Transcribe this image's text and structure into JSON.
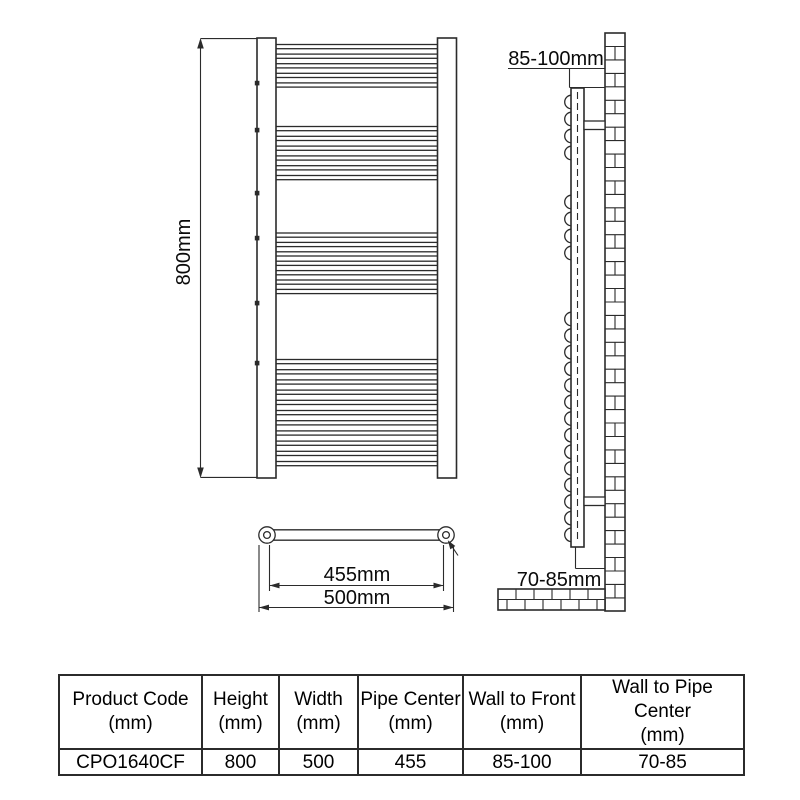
{
  "diagram": {
    "front_view": {
      "height_label": "800mm",
      "bar_groups": [
        {
          "y": 44.5,
          "pitch": 9.6,
          "count": 5
        },
        {
          "y": 126.5,
          "pitch": 9.8,
          "count": 6
        },
        {
          "y": 233.0,
          "pitch": 9.4,
          "count": 7
        },
        {
          "y": 359.5,
          "pitch": 10.2,
          "count": 11
        }
      ],
      "bracket_marks_y": [
        83,
        130,
        193,
        238,
        303,
        363
      ]
    },
    "side_view": {
      "wall_to_front_label": "85-100mm",
      "wall_to_pipe_label": "70-85mm",
      "bump_groups": [
        {
          "y": 102,
          "pitch": 17.0,
          "count": 4
        },
        {
          "y": 202,
          "pitch": 17.0,
          "count": 4
        },
        {
          "y": 319,
          "pitch": 16.6,
          "count": 14
        }
      ]
    },
    "bottom_view": {
      "pipe_center_label": "455mm",
      "overall_width_label": "500mm"
    }
  },
  "spec_table": {
    "columns": [
      {
        "label": "Product Code",
        "unit": "(mm)"
      },
      {
        "label": "Height",
        "unit": "(mm)"
      },
      {
        "label": "Width",
        "unit": "(mm)"
      },
      {
        "label": "Pipe Center",
        "unit": "(mm)"
      },
      {
        "label": "Wall to Front",
        "unit": "(mm)"
      },
      {
        "label": "Wall to Pipe Center",
        "unit": "(mm)"
      }
    ],
    "rows": [
      [
        "CPO1640CF",
        "800",
        "500",
        "455",
        "85-100",
        "70-85"
      ]
    ]
  },
  "colors": {
    "line": "#2b2b2b",
    "background": "#ffffff",
    "text": "#000000"
  }
}
